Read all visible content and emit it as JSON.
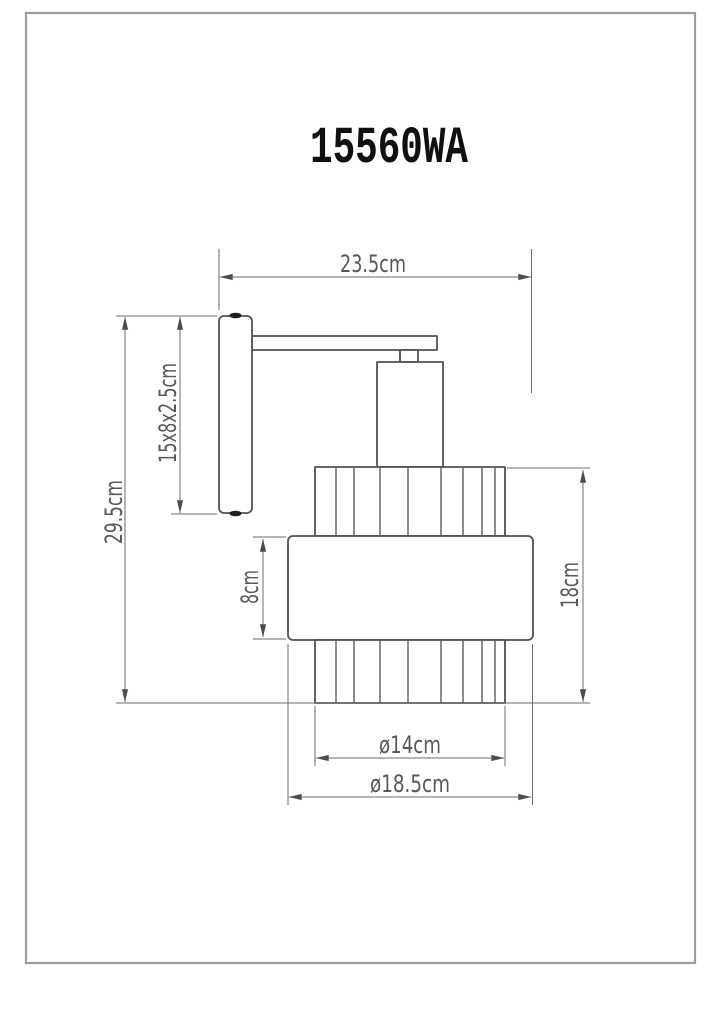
{
  "title": "15560WA",
  "drawing": {
    "type": "wall-lamp-dimension-drawing",
    "dimensions": {
      "total_width": "23.5cm",
      "total_height": "29.5cm",
      "backplate_size": "15x8x2.5cm",
      "middle_band_height": "8cm",
      "shade_height": "18cm",
      "inner_diameter": "ø14cm",
      "outer_diameter": "ø18.5cm"
    }
  },
  "colors": {
    "background": "#ffffff",
    "page_border": "#9c9c9c",
    "object_line": "#515151",
    "dimension_line": "#6b6b6b",
    "dimension_text": "#585858",
    "title_text": "#101010",
    "screw": "#1f1f1f"
  }
}
